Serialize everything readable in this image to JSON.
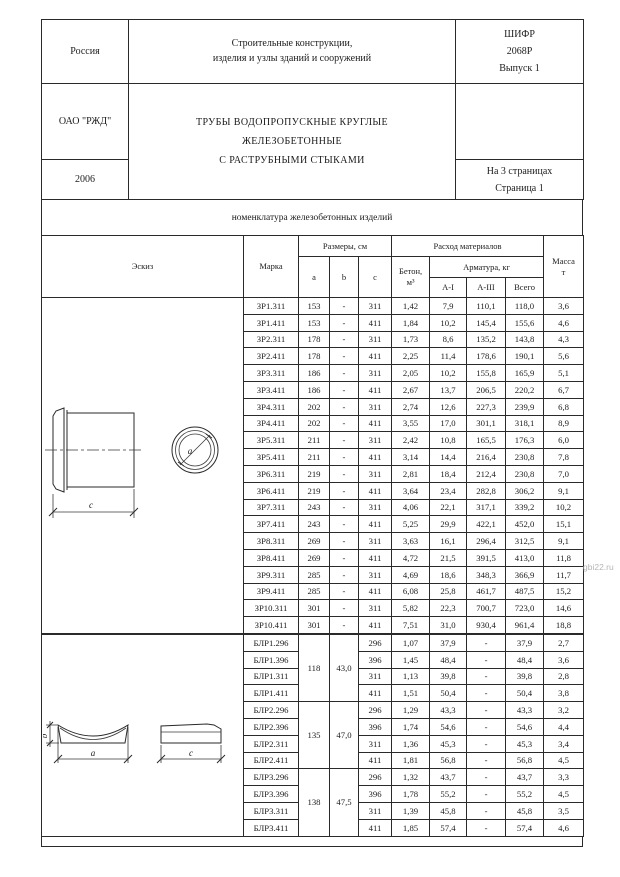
{
  "header": {
    "country": "Россия",
    "org": "ОАО \"РЖД\"",
    "year": "2006",
    "series_title_l1": "Строительные конструкции,",
    "series_title_l2": "изделия и узлы зданий и сооружений",
    "product_title_l1": "ТРУБЫ ВОДОПРОПУСКНЫЕ КРУГЛЫЕ",
    "product_title_l2": "ЖЕЛЕЗОБЕТОННЫЕ",
    "product_title_l3": "С РАСТРУБНЫМИ СТЫКАМИ",
    "code_l1": "ШИФР",
    "code_l2": "2068Р",
    "code_l3": "Выпуск 1",
    "pages_l1": "На 3 страницах",
    "pages_l2": "Страница 1"
  },
  "section_title": "номенклатура железобетонных изделий",
  "table": {
    "head": {
      "sketch": "Эскиз",
      "mark": "Марка",
      "dims": "Размеры, см",
      "a": "a",
      "b": "b",
      "c": "c",
      "concrete_l1": "Бетон,",
      "concrete_l2": "м³",
      "consumption": "Расход материалов",
      "rebar": "Арматура, кг",
      "ai": "А-I",
      "aiii": "А-III",
      "total": "Всего",
      "mass_l1": "Масса",
      "mass_l2": "т"
    },
    "zr": {
      "rows": [
        [
          "ЗР1.311",
          "153",
          "-",
          "311",
          "1,42",
          "7,9",
          "110,1",
          "118,0",
          "3,6"
        ],
        [
          "ЗР1.411",
          "153",
          "-",
          "411",
          "1,84",
          "10,2",
          "145,4",
          "155,6",
          "4,6"
        ],
        [
          "ЗР2.311",
          "178",
          "-",
          "311",
          "1,73",
          "8,6",
          "135,2",
          "143,8",
          "4,3"
        ],
        [
          "ЗР2.411",
          "178",
          "-",
          "411",
          "2,25",
          "11,4",
          "178,6",
          "190,1",
          "5,6"
        ],
        [
          "ЗР3.311",
          "186",
          "-",
          "311",
          "2,05",
          "10,2",
          "155,8",
          "165,9",
          "5,1"
        ],
        [
          "ЗР3.411",
          "186",
          "-",
          "411",
          "2,67",
          "13,7",
          "206,5",
          "220,2",
          "6,7"
        ],
        [
          "ЗР4.311",
          "202",
          "-",
          "311",
          "2,74",
          "12,6",
          "227,3",
          "239,9",
          "6,8"
        ],
        [
          "ЗР4.411",
          "202",
          "-",
          "411",
          "3,55",
          "17,0",
          "301,1",
          "318,1",
          "8,9"
        ],
        [
          "ЗР5.311",
          "211",
          "-",
          "311",
          "2,42",
          "10,8",
          "165,5",
          "176,3",
          "6,0"
        ],
        [
          "ЗР5.411",
          "211",
          "-",
          "411",
          "3,14",
          "14,4",
          "216,4",
          "230,8",
          "7,8"
        ],
        [
          "ЗР6.311",
          "219",
          "-",
          "311",
          "2,81",
          "18,4",
          "212,4",
          "230,8",
          "7,0"
        ],
        [
          "ЗР6.411",
          "219",
          "-",
          "411",
          "3,64",
          "23,4",
          "282,8",
          "306,2",
          "9,1"
        ],
        [
          "ЗР7.311",
          "243",
          "-",
          "311",
          "4,06",
          "22,1",
          "317,1",
          "339,2",
          "10,2"
        ],
        [
          "ЗР7.411",
          "243",
          "-",
          "411",
          "5,25",
          "29,9",
          "422,1",
          "452,0",
          "15,1"
        ],
        [
          "ЗР8.311",
          "269",
          "-",
          "311",
          "3,63",
          "16,1",
          "296,4",
          "312,5",
          "9,1"
        ],
        [
          "ЗР8.411",
          "269",
          "-",
          "411",
          "4,72",
          "21,5",
          "391,5",
          "413,0",
          "11,8"
        ],
        [
          "ЗР9.311",
          "285",
          "-",
          "311",
          "4,69",
          "18,6",
          "348,3",
          "366,9",
          "11,7"
        ],
        [
          "ЗР9.411",
          "285",
          "-",
          "411",
          "6,08",
          "25,8",
          "461,7",
          "487,5",
          "15,2"
        ],
        [
          "ЗР10.311",
          "301",
          "-",
          "311",
          "5,82",
          "22,3",
          "700,7",
          "723,0",
          "14,6"
        ],
        [
          "ЗР10.411",
          "301",
          "-",
          "411",
          "7,51",
          "31,0",
          "930,4",
          "961,4",
          "18,8"
        ]
      ]
    },
    "blr": {
      "groups": [
        {
          "a": "118",
          "b": "43,0",
          "rows": [
            [
              "БЛР1.296",
              "296",
              "1,07",
              "37,9",
              "-",
              "37,9",
              "2,7"
            ],
            [
              "БЛР1.396",
              "396",
              "1,45",
              "48,4",
              "-",
              "48,4",
              "3,6"
            ],
            [
              "БЛР1.311",
              "311",
              "1,13",
              "39,8",
              "-",
              "39,8",
              "2,8"
            ],
            [
              "БЛР1.411",
              "411",
              "1,51",
              "50,4",
              "-",
              "50,4",
              "3,8"
            ]
          ]
        },
        {
          "a": "135",
          "b": "47,0",
          "rows": [
            [
              "БЛР2.296",
              "296",
              "1,29",
              "43,3",
              "-",
              "43,3",
              "3,2"
            ],
            [
              "БЛР2.396",
              "396",
              "1,74",
              "54,6",
              "-",
              "54,6",
              "4,4"
            ],
            [
              "БЛР2.311",
              "311",
              "1,36",
              "45,3",
              "-",
              "45,3",
              "3,4"
            ],
            [
              "БЛР2.411",
              "411",
              "1,81",
              "56,8",
              "-",
              "56,8",
              "4,5"
            ]
          ]
        },
        {
          "a": "138",
          "b": "47,5",
          "rows": [
            [
              "БЛР3.296",
              "296",
              "1,32",
              "43,7",
              "-",
              "43,7",
              "3,3"
            ],
            [
              "БЛР3.396",
              "396",
              "1,78",
              "55,2",
              "-",
              "55,2",
              "4,5"
            ],
            [
              "БЛР3.311",
              "311",
              "1,39",
              "45,8",
              "-",
              "45,8",
              "3,5"
            ],
            [
              "БЛР3.411",
              "411",
              "1,85",
              "57,4",
              "-",
              "57,4",
              "4,6"
            ]
          ]
        }
      ]
    }
  },
  "sketches": {
    "pipe": {
      "dim_c": "c",
      "dim_a": "a"
    },
    "saddle": {
      "dim_b": "b",
      "dim_a": "a",
      "dim_c": "c"
    }
  },
  "watermark": "gbi22.ru"
}
